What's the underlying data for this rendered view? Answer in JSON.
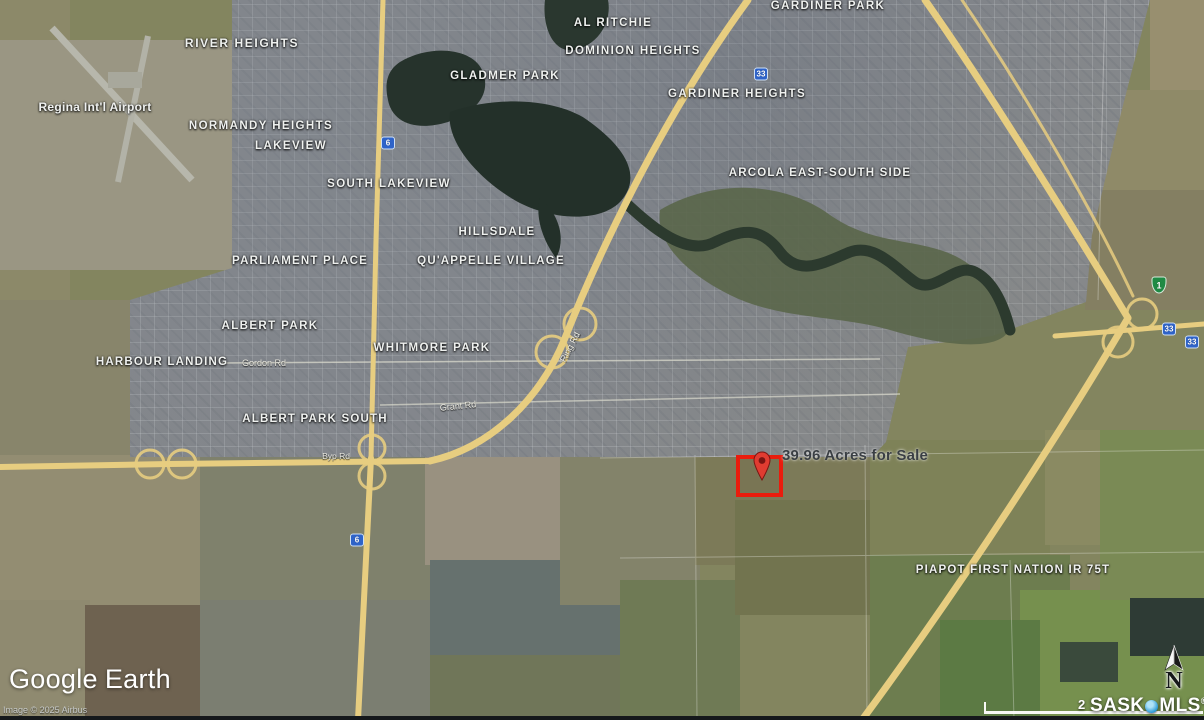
{
  "map": {
    "attribution": "Image © 2025 Airbus",
    "logo": {
      "part1": "Google",
      "part2": "Earth"
    },
    "scale_label": "2",
    "brand": {
      "sask": "SASK",
      "mls": "MLS",
      "reg": "®"
    },
    "north_label": "N",
    "placemark": {
      "label": "39.96 Acres for Sale"
    }
  },
  "colors": {
    "highway": "#e7cd80",
    "parcel_outline": "#ea1c0d",
    "water": "#26332c",
    "shield_blue": "#2e63c9",
    "shield_green": "#1f8a44"
  },
  "labels": [
    {
      "text": "GARDINER PARK",
      "x": 828,
      "y": 6,
      "size": 11.5,
      "spacing": 1.4
    },
    {
      "text": "RIVER HEIGHTS",
      "x": 242,
      "y": 43,
      "size": 12,
      "spacing": 1.6
    },
    {
      "text": "AL RITCHIE",
      "x": 613,
      "y": 23,
      "size": 11.5,
      "spacing": 1.4
    },
    {
      "text": "DOMINION HEIGHTS",
      "x": 633,
      "y": 51,
      "size": 11.5,
      "spacing": 1.4
    },
    {
      "text": "GLADMER PARK",
      "x": 505,
      "y": 76,
      "size": 11.5,
      "spacing": 1.4
    },
    {
      "text": "GARDINER HEIGHTS",
      "x": 737,
      "y": 94,
      "size": 11.5,
      "spacing": 1.4
    },
    {
      "text": "Regina Int'l Airport",
      "x": 95,
      "y": 107,
      "size": 12,
      "spacing": 0.3
    },
    {
      "text": "NORMANDY HEIGHTS",
      "x": 261,
      "y": 126,
      "size": 11.5,
      "spacing": 1.4
    },
    {
      "text": "LAKEVIEW",
      "x": 291,
      "y": 146,
      "size": 11.5,
      "spacing": 1.4
    },
    {
      "text": "SOUTH LAKEVIEW",
      "x": 389,
      "y": 184,
      "size": 11.5,
      "spacing": 1.4
    },
    {
      "text": "ARCOLA EAST-SOUTH SIDE",
      "x": 820,
      "y": 173,
      "size": 11.5,
      "spacing": 1.2
    },
    {
      "text": "HILLSDALE",
      "x": 497,
      "y": 232,
      "size": 11.5,
      "spacing": 1.4
    },
    {
      "text": "PARLIAMENT PLACE",
      "x": 300,
      "y": 261,
      "size": 11.5,
      "spacing": 1.2
    },
    {
      "text": "QU'APPELLE VILLAGE",
      "x": 491,
      "y": 261,
      "size": 11.5,
      "spacing": 1.2
    },
    {
      "text": "ALBERT PARK",
      "x": 270,
      "y": 326,
      "size": 11.5,
      "spacing": 1.4
    },
    {
      "text": "WHITMORE PARK",
      "x": 432,
      "y": 348,
      "size": 11.5,
      "spacing": 1.4
    },
    {
      "text": "HARBOUR LANDING",
      "x": 162,
      "y": 362,
      "size": 11.5,
      "spacing": 1.2
    },
    {
      "text": "ALBERT PARK SOUTH",
      "x": 315,
      "y": 419,
      "size": 11.5,
      "spacing": 1.2
    },
    {
      "text": "PIAPOT FIRST NATION IR 75T",
      "x": 1013,
      "y": 570,
      "size": 11.5,
      "spacing": 1.2
    }
  ],
  "road_labels": [
    {
      "text": "Gordon Rd",
      "x": 264,
      "y": 363,
      "size": 9,
      "rot": 0
    },
    {
      "text": "Grant Rd",
      "x": 458,
      "y": 406,
      "size": 9,
      "rot": -6
    },
    {
      "text": "Ring Rd",
      "x": 570,
      "y": 347,
      "size": 9,
      "rot": -62
    },
    {
      "text": "Byp Rd",
      "x": 336,
      "y": 456,
      "size": 8.5,
      "rot": 0
    }
  ],
  "shields": [
    {
      "num": "6",
      "x": 388,
      "y": 143,
      "type": "blue"
    },
    {
      "num": "6",
      "x": 357,
      "y": 540,
      "type": "blue"
    },
    {
      "num": "33",
      "x": 761,
      "y": 74,
      "type": "blue"
    },
    {
      "num": "33",
      "x": 1169,
      "y": 329,
      "type": "blue"
    },
    {
      "num": "33",
      "x": 1192,
      "y": 342,
      "type": "blue"
    },
    {
      "num": "1",
      "x": 1159,
      "y": 285,
      "type": "green"
    }
  ],
  "fields": [
    {
      "x": 0,
      "y": 0,
      "w": 70,
      "h": 310,
      "c": "#8c8969"
    },
    {
      "x": 0,
      "y": 40,
      "w": 240,
      "h": 230,
      "c": "#9a9683"
    },
    {
      "x": 0,
      "y": 300,
      "w": 160,
      "h": 170,
      "c": "#88856b"
    },
    {
      "x": 1150,
      "y": 0,
      "w": 54,
      "h": 130,
      "c": "#988f6f"
    },
    {
      "x": 1090,
      "y": 90,
      "w": 114,
      "h": 110,
      "c": "#8f8a68"
    },
    {
      "x": 1085,
      "y": 190,
      "w": 119,
      "h": 120,
      "c": "#847f62"
    },
    {
      "x": 555,
      "y": 225,
      "w": 150,
      "h": 115,
      "c": "#8b8168"
    },
    {
      "x": 600,
      "y": 115,
      "w": 90,
      "h": 115,
      "c": "#827a5e"
    },
    {
      "x": 0,
      "y": 455,
      "w": 210,
      "h": 150,
      "c": "#938d72"
    },
    {
      "x": 0,
      "y": 600,
      "w": 90,
      "h": 120,
      "c": "#8f8a70"
    },
    {
      "x": 85,
      "y": 605,
      "w": 130,
      "h": 115,
      "c": "#6e6250"
    },
    {
      "x": 200,
      "y": 455,
      "w": 230,
      "h": 150,
      "c": "#7f816c"
    },
    {
      "x": 200,
      "y": 600,
      "w": 240,
      "h": 120,
      "c": "#7b7e71"
    },
    {
      "x": 425,
      "y": 455,
      "w": 140,
      "h": 110,
      "c": "#999180"
    },
    {
      "x": 430,
      "y": 560,
      "w": 200,
      "h": 110,
      "c": "#66716e"
    },
    {
      "x": 560,
      "y": 455,
      "w": 140,
      "h": 150,
      "c": "#83836a"
    },
    {
      "x": 430,
      "y": 655,
      "w": 270,
      "h": 65,
      "c": "#707659"
    },
    {
      "x": 620,
      "y": 580,
      "w": 120,
      "h": 140,
      "c": "#6f7a55"
    },
    {
      "x": 695,
      "y": 440,
      "w": 175,
      "h": 125,
      "c": "#7c7a58"
    },
    {
      "x": 735,
      "y": 500,
      "w": 140,
      "h": 115,
      "c": "#72744f"
    },
    {
      "x": 870,
      "y": 440,
      "w": 180,
      "h": 120,
      "c": "#7e8258"
    },
    {
      "x": 1045,
      "y": 430,
      "w": 160,
      "h": 115,
      "c": "#8a8a62"
    },
    {
      "x": 870,
      "y": 555,
      "w": 200,
      "h": 165,
      "c": "#6d7d4f"
    },
    {
      "x": 1020,
      "y": 590,
      "w": 184,
      "h": 130,
      "c": "#76904e"
    },
    {
      "x": 1100,
      "y": 430,
      "w": 104,
      "h": 170,
      "c": "#7a8a55"
    },
    {
      "x": 940,
      "y": 620,
      "w": 100,
      "h": 100,
      "c": "#5c7a44"
    },
    {
      "x": 1130,
      "y": 598,
      "w": 74,
      "h": 58,
      "c": "#2e3b35"
    },
    {
      "x": 1060,
      "y": 642,
      "w": 58,
      "h": 40,
      "c": "#3a4a3c"
    }
  ]
}
